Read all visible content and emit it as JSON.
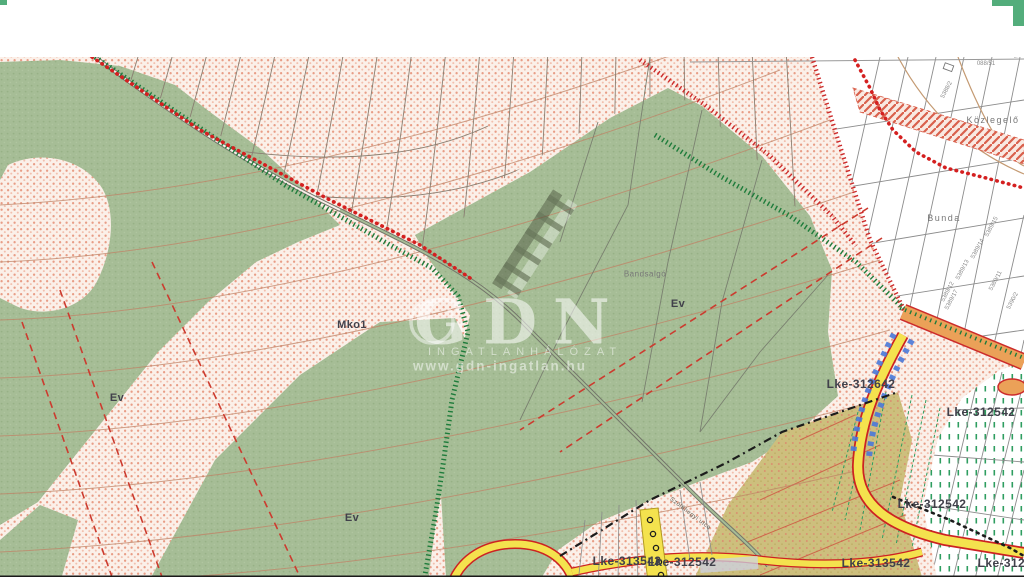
{
  "watermark": {
    "brand": "GDN",
    "tagline": "INGATLANHÁLÓZAT",
    "url": "www.gdn-ingatlan.hu"
  },
  "map": {
    "zone_labels": [
      {
        "text": "Mko1"
      },
      {
        "text": "Ev"
      },
      {
        "text": "Ev"
      },
      {
        "text": "Ev"
      },
      {
        "text": "Lke-312642"
      },
      {
        "text": "Lke-312542"
      },
      {
        "text": "Lke-312542"
      },
      {
        "text": "Lke-313542"
      },
      {
        "text": "Lke-312542"
      },
      {
        "text": "Lke-313542"
      },
      {
        "text": "Lke-312542"
      }
    ],
    "place_labels": [
      {
        "text": "Közlegelő"
      },
      {
        "text": "Bunda"
      },
      {
        "text": "Bandsalgó"
      }
    ],
    "street_label": {
      "text": "Szőlőhegyi utca"
    },
    "parcel_numbers": [
      {
        "text": "088/51"
      },
      {
        "text": "5388/2"
      },
      {
        "text": "5389/15"
      },
      {
        "text": "5389/14"
      },
      {
        "text": "5389/13"
      },
      {
        "text": "5389/12"
      },
      {
        "text": "5389/11"
      },
      {
        "text": "5389/17"
      },
      {
        "text": "5390/2"
      }
    ],
    "colors": {
      "farmland_pink": "#f3c9b9",
      "forest_green": "#a6bd96",
      "road_yellow": "#f4e24e",
      "road_orange": "#eba158",
      "boundary_red": "#d42020",
      "crest_green": "#1e7c3b",
      "zone_olive": "#cdbf7d"
    }
  }
}
